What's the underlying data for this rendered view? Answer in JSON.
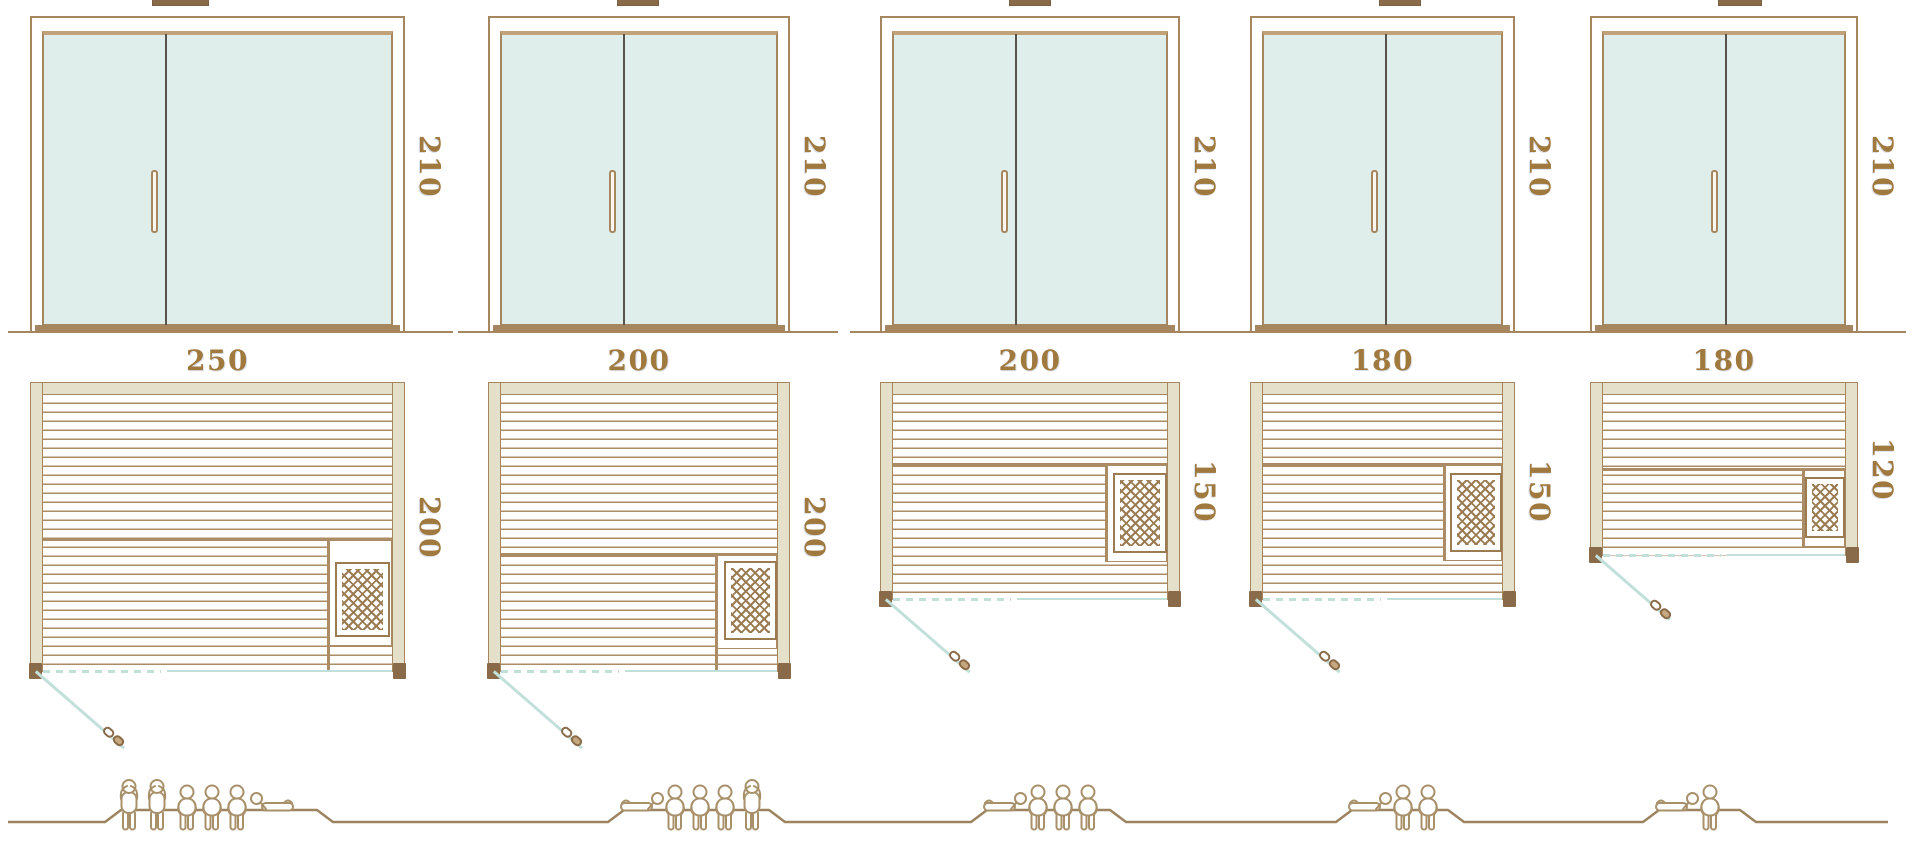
{
  "diagram": {
    "kind": "sauna-size-comparison"
  },
  "units": [
    {
      "door": {
        "height_label": "210"
      },
      "plan": {
        "width_label": "250",
        "depth_label": "200"
      },
      "capacity": {
        "standing": 2,
        "seated": 3,
        "reclining": 1,
        "total": 6
      }
    },
    {
      "door": {
        "height_label": "210"
      },
      "plan": {
        "width_label": "200",
        "depth_label": "200"
      },
      "capacity": {
        "standing": 1,
        "seated": 3,
        "reclining": 1,
        "total": 5
      }
    },
    {
      "door": {
        "height_label": "210"
      },
      "plan": {
        "width_label": "200",
        "depth_label": "150"
      },
      "capacity": {
        "standing": 0,
        "seated": 3,
        "reclining": 1,
        "total": 4
      }
    },
    {
      "door": {
        "height_label": "210"
      },
      "plan": {
        "width_label": "180",
        "depth_label": "150"
      },
      "capacity": {
        "standing": 0,
        "seated": 2,
        "reclining": 1,
        "total": 3
      }
    },
    {
      "door": {
        "height_label": "210"
      },
      "plan": {
        "width_label": "180",
        "depth_label": "120"
      },
      "capacity": {
        "standing": 0,
        "seated": 1,
        "reclining": 1,
        "total": 2
      }
    }
  ],
  "colors": {
    "frame_brown": "#a5865f",
    "dark_brown": "#8a6b49",
    "wall_beige": "#e4e0c9",
    "glass_mint": "#dfeeea",
    "divider_gray": "#55534b",
    "swing_cyan": "#c2e0da",
    "label_brown": "#a0793f",
    "figure_tan": "#a8916a",
    "plank_brown": "#ab8c64",
    "hatch_brown": "#9b7c52"
  }
}
